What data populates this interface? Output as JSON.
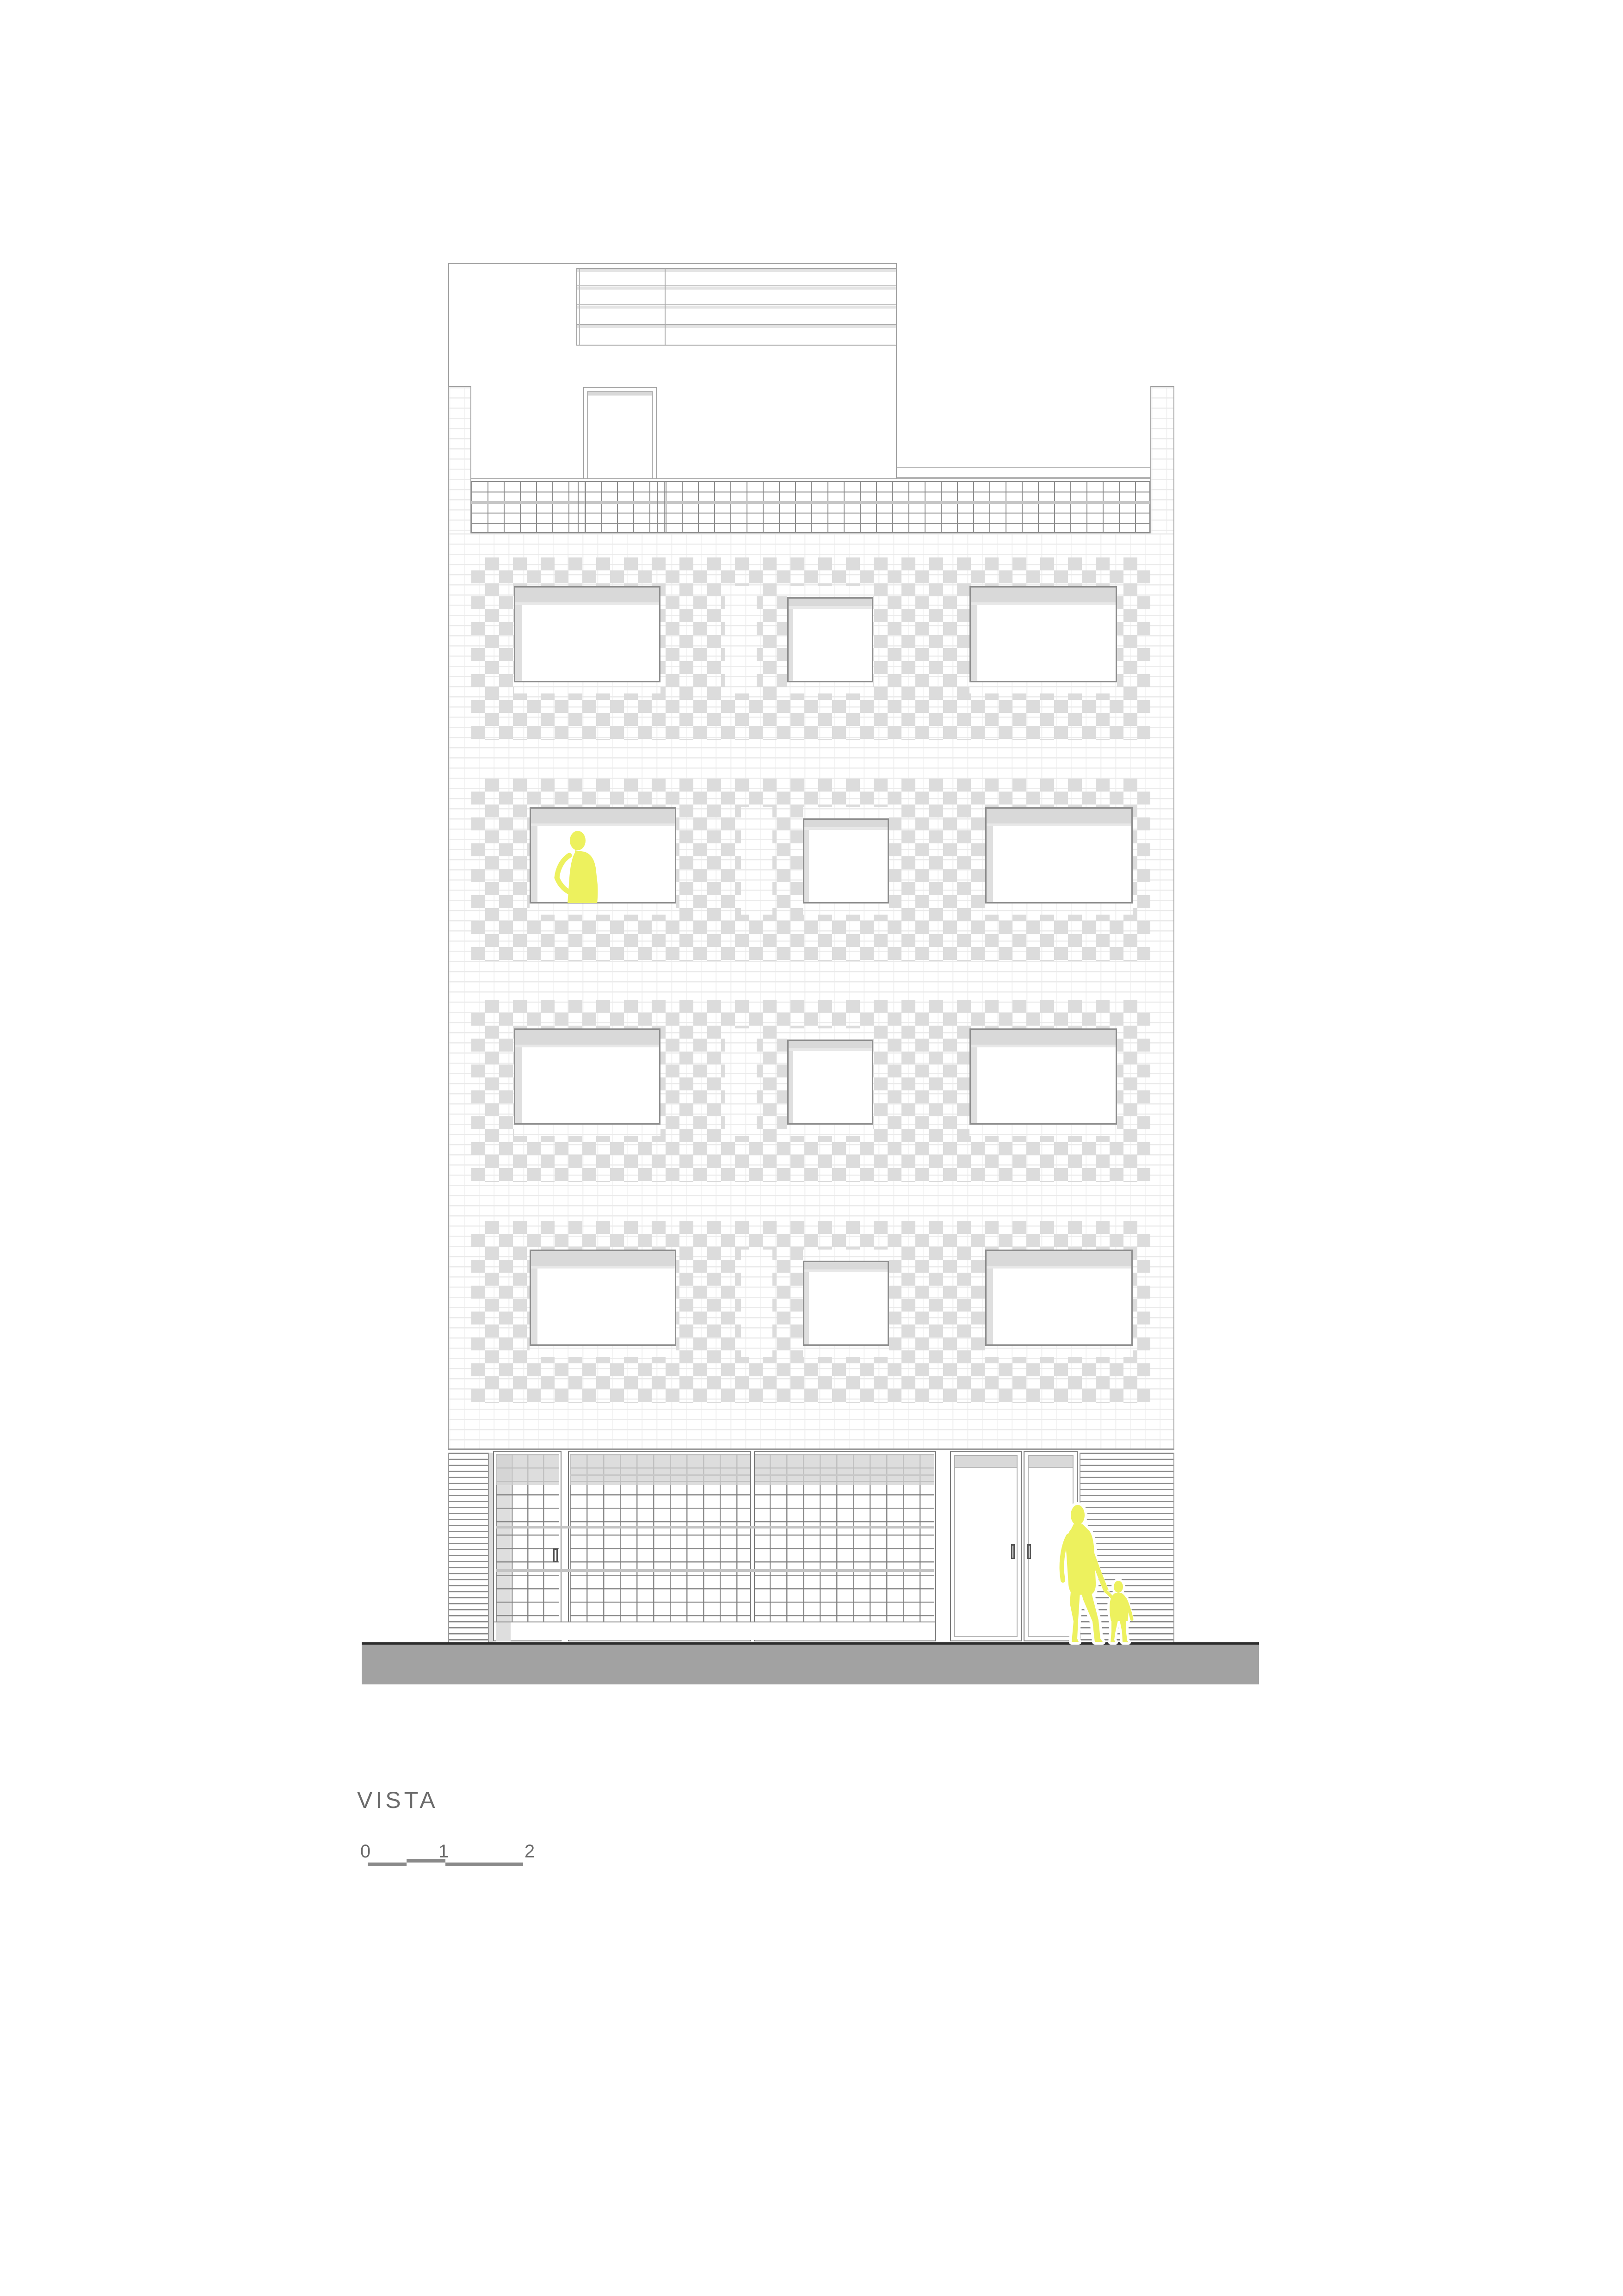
{
  "title": {
    "label": "VISTA"
  },
  "scale_bar": {
    "labels": [
      "0",
      "1",
      "2"
    ],
    "unit_hint": "meters",
    "ticks_x": [
      795,
      963,
      1131
    ]
  },
  "drawing": {
    "type": "architectural-elevation",
    "building": {
      "floors": 4,
      "windows_per_floor": [
        "large",
        "small",
        "large"
      ],
      "rooftop": [
        "penthouse-volume",
        "pergola-grid",
        "roof-access-door"
      ],
      "roof_terrace_railing": true,
      "side_brick_pilasters": 2,
      "ground_floor_elements": [
        "louver-panel",
        "glass-block-door",
        "glass-block-storefront",
        "entry-door",
        "entry-door",
        "louver-panel"
      ],
      "facade_finish": "white brick with gray checkerboard bands around windows"
    },
    "figures": [
      {
        "name": "person-at-window",
        "location": "third-floor-left-window"
      },
      {
        "name": "adult-walking",
        "location": "sidewalk"
      },
      {
        "name": "child-walking",
        "location": "sidewalk"
      }
    ],
    "colors": {
      "figure_yellow": "#edf15e",
      "checker_gray": "#dcdcdc",
      "window_header_gray": "#d9d9d9",
      "ground_gray": "#a2a2a2",
      "line_gray": "#8f8f8f",
      "text_gray": "#6b6b6b"
    }
  }
}
